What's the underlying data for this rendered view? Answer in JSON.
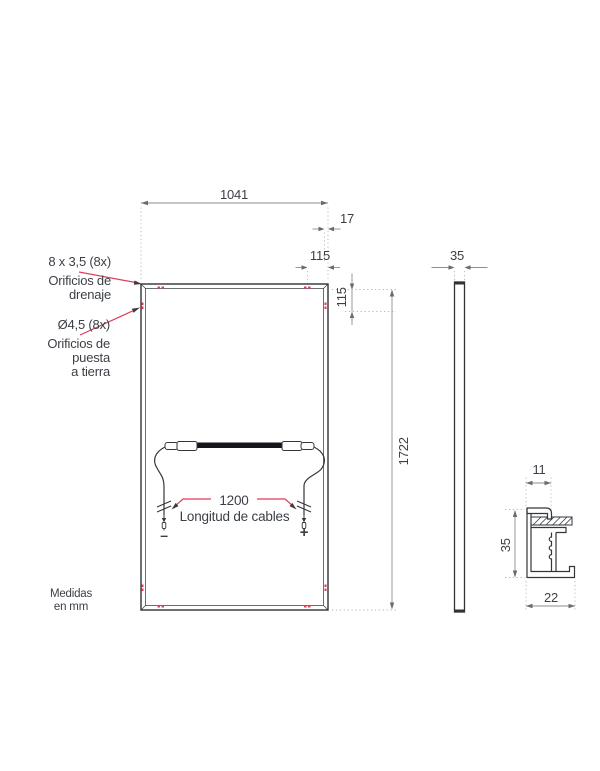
{
  "front_view": {
    "width": "1041",
    "edge_offset": "17",
    "hole_offset_h": "115",
    "hole_offset_v": "115",
    "height": "1722",
    "cable_length": "1200",
    "cable_caption": "Longitud de cables",
    "negative_sign": "–",
    "positive_sign": "+",
    "drain_holes_label": [
      "8 x 3,5 (8x)",
      "Orificios de",
      "drenaje"
    ],
    "ground_holes_label": [
      "Ø4,5 (8x)",
      "Orificios de",
      "puesta",
      "a tierra"
    ]
  },
  "side_view": {
    "thickness": "35"
  },
  "profile_detail": {
    "top_width": "11",
    "height": "35",
    "bottom_width": "22"
  },
  "units_note": [
    "Medidas",
    "en mm"
  ],
  "colors": {
    "accent_red": "#e13b5a",
    "drawing_line": "#2f3237",
    "dimension_gray": "#8d8d8d",
    "text": "#3b3f46"
  }
}
